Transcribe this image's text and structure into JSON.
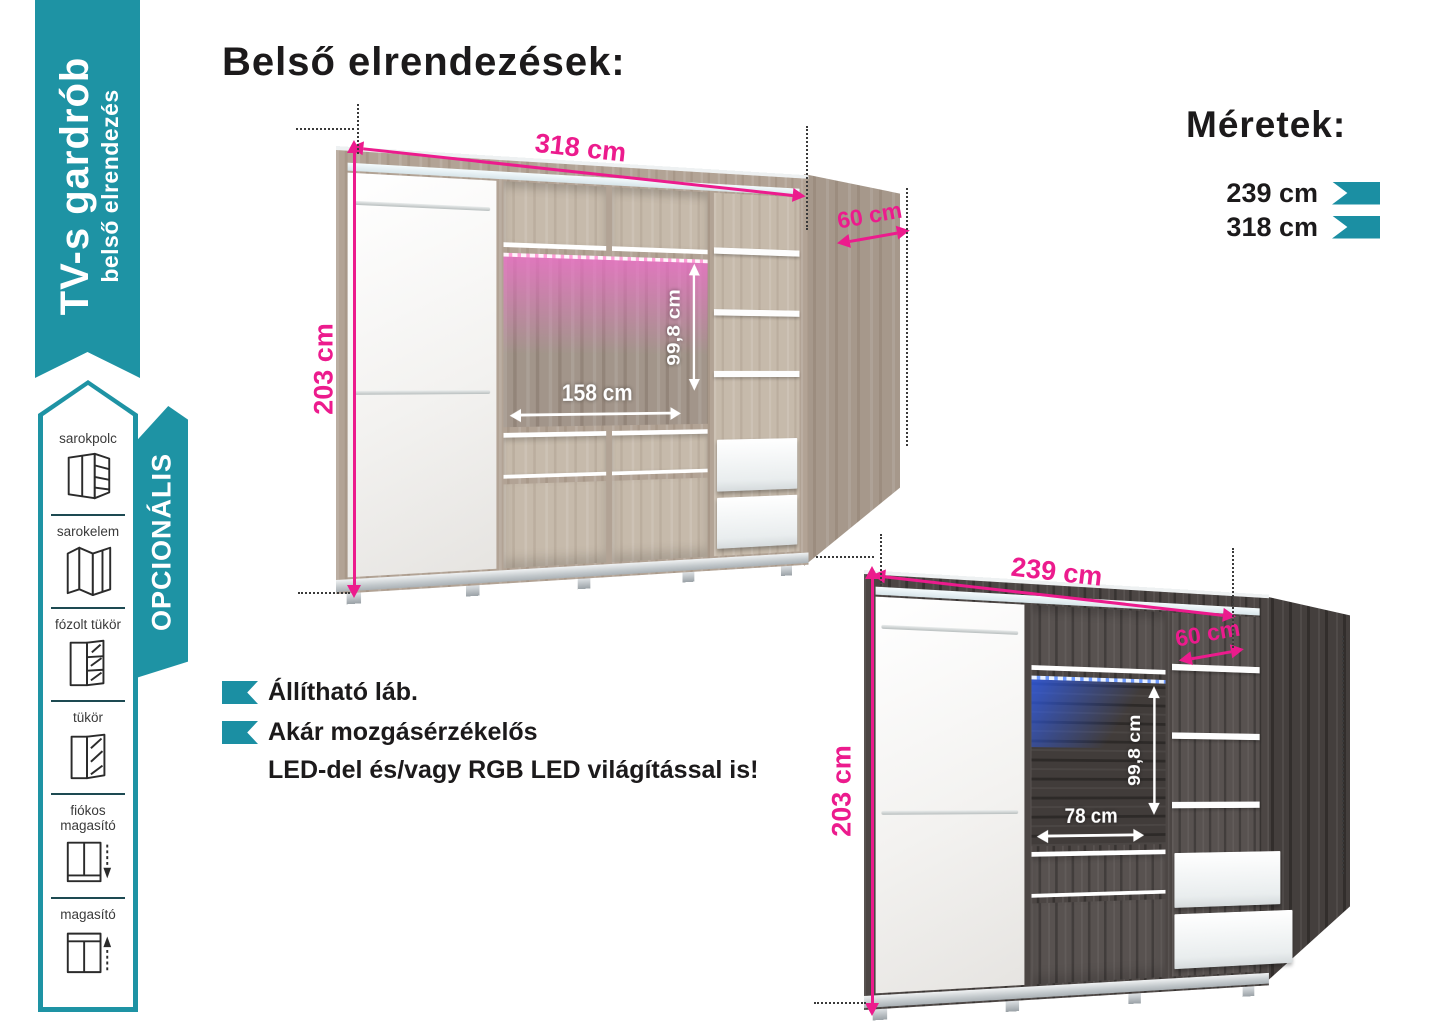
{
  "colors": {
    "teal": "#1e93a4",
    "pink": "#ec1b8d",
    "wood_light": "#b2a395",
    "wood_dark": "#4c4644",
    "led_pink": "#f36ecd",
    "led_blue": "#2f61ff"
  },
  "sidebar": {
    "ribbon": {
      "title": "TV-s gardrób",
      "subtitle": "belső elrendezés"
    },
    "optional": {
      "label": "OPCIONÁLIS",
      "items": [
        {
          "label": "sarokpolc",
          "icon": "corner-shelf-icon"
        },
        {
          "label": "sarokelem",
          "icon": "corner-element-icon"
        },
        {
          "label": "fózolt tükör",
          "icon": "bevelled-mirror-icon"
        },
        {
          "label": "tükör",
          "icon": "mirror-icon"
        },
        {
          "label": "fiókos magasító",
          "icon": "drawer-extension-icon"
        },
        {
          "label": "magasító",
          "icon": "extension-icon"
        }
      ]
    }
  },
  "main": {
    "title": "Belső elrendezések:"
  },
  "dimensions_panel": {
    "heading": "Méretek:",
    "sizes": [
      {
        "label": "239 cm"
      },
      {
        "label": "318 cm"
      }
    ]
  },
  "features": {
    "item1": "Állítható láb.",
    "item2": "Akár mozgásérzékelős",
    "item2b": "LED-del és/vagy RGB LED világítással is!"
  },
  "wardrobe_318": {
    "width": "318 cm",
    "height": "203 cm",
    "depth": "60 cm",
    "tv_width": "158 cm",
    "tv_height": "99,8 cm"
  },
  "wardrobe_239": {
    "width": "239 cm",
    "height": "203 cm",
    "depth": "60 cm",
    "tv_width": "78 cm",
    "tv_height": "99,8 cm"
  }
}
